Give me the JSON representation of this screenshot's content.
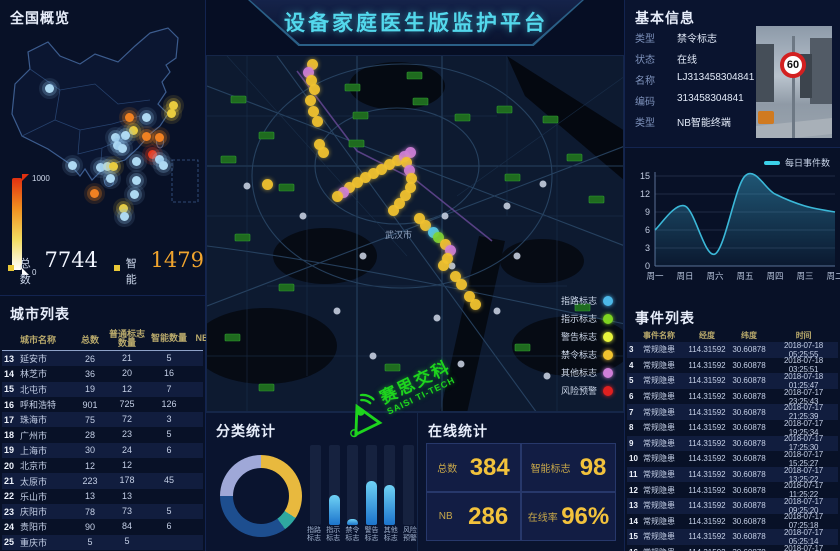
{
  "header": {
    "title": "设备家庭医生版监护平台"
  },
  "overview": {
    "title": "全国概览",
    "scale_max": "1000",
    "scale_min": "0",
    "total_label": "总数",
    "total_value": "7744",
    "smart_label": "智能",
    "smart_value": "1479",
    "dots": [
      {
        "x": 49,
        "y": 88,
        "c": "b"
      },
      {
        "x": 173,
        "y": 105,
        "c": "y"
      },
      {
        "x": 171,
        "y": 113,
        "c": "y"
      },
      {
        "x": 129,
        "y": 117,
        "c": "o"
      },
      {
        "x": 146,
        "y": 117,
        "c": "b"
      },
      {
        "x": 146,
        "y": 136,
        "c": "o"
      },
      {
        "x": 159,
        "y": 137,
        "c": "o"
      },
      {
        "x": 133,
        "y": 130,
        "c": "y"
      },
      {
        "x": 115,
        "y": 137,
        "c": "b"
      },
      {
        "x": 125,
        "y": 135,
        "c": "b"
      },
      {
        "x": 117,
        "y": 145,
        "c": "b"
      },
      {
        "x": 122,
        "y": 148,
        "c": "b"
      },
      {
        "x": 152,
        "y": 154,
        "c": "r"
      },
      {
        "x": 159,
        "y": 159,
        "c": "b"
      },
      {
        "x": 136,
        "y": 161,
        "c": "b"
      },
      {
        "x": 72,
        "y": 165,
        "c": "b"
      },
      {
        "x": 100,
        "y": 167,
        "c": "b"
      },
      {
        "x": 107,
        "y": 166,
        "c": "b"
      },
      {
        "x": 113,
        "y": 166,
        "c": "y"
      },
      {
        "x": 94,
        "y": 193,
        "c": "o"
      },
      {
        "x": 110,
        "y": 178,
        "c": "b"
      },
      {
        "x": 136,
        "y": 180,
        "c": "b"
      },
      {
        "x": 134,
        "y": 194,
        "c": "b"
      },
      {
        "x": 123,
        "y": 208,
        "c": "y"
      },
      {
        "x": 124,
        "y": 216,
        "c": "b"
      },
      {
        "x": 163,
        "y": 165,
        "c": "b"
      }
    ]
  },
  "city_list": {
    "title": "城市列表",
    "columns": [
      "城市名称",
      "总数",
      "普通标志数量",
      "智能数量",
      "NB数量"
    ],
    "rows": [
      {
        "idx": "13",
        "name": "延安市",
        "total": "26",
        "normal": "21",
        "smart": "5",
        "nb": "0"
      },
      {
        "idx": "14",
        "name": "林芝市",
        "total": "36",
        "normal": "20",
        "smart": "16",
        "nb": "0"
      },
      {
        "idx": "15",
        "name": "北屯市",
        "total": "19",
        "normal": "12",
        "smart": "7",
        "nb": "0"
      },
      {
        "idx": "16",
        "name": "呼和浩特",
        "total": "901",
        "normal": "725",
        "smart": "126",
        "nb": "50"
      },
      {
        "idx": "17",
        "name": "珠海市",
        "total": "75",
        "normal": "72",
        "smart": "3",
        "nb": "0"
      },
      {
        "idx": "18",
        "name": "广州市",
        "total": "28",
        "normal": "23",
        "smart": "5",
        "nb": "0"
      },
      {
        "idx": "19",
        "name": "上海市",
        "total": "30",
        "normal": "24",
        "smart": "6",
        "nb": "0"
      },
      {
        "idx": "20",
        "name": "北京市",
        "total": "12",
        "normal": "12",
        "smart": "",
        "nb": "0"
      },
      {
        "idx": "21",
        "name": "太原市",
        "total": "223",
        "normal": "178",
        "smart": "45",
        "nb": "0"
      },
      {
        "idx": "22",
        "name": "乐山市",
        "total": "13",
        "normal": "13",
        "smart": "",
        "nb": "0"
      },
      {
        "idx": "23",
        "name": "庆阳市",
        "total": "78",
        "normal": "73",
        "smart": "5",
        "nb": "0"
      },
      {
        "idx": "24",
        "name": "贵阳市",
        "total": "90",
        "normal": "84",
        "smart": "6",
        "nb": "0"
      },
      {
        "idx": "25",
        "name": "重庆市",
        "total": "5",
        "normal": "5",
        "smart": "",
        "nb": "0"
      }
    ]
  },
  "map": {
    "city_label": "武汉市",
    "legend": [
      {
        "label": "指路标志",
        "color": "#4db8e8"
      },
      {
        "label": "指示标志",
        "color": "#7ed321"
      },
      {
        "label": "警告标志",
        "color": "#e8f53c"
      },
      {
        "label": "禁令标志",
        "color": "#f2c32f"
      },
      {
        "label": "其他标志",
        "color": "#cf7fd8"
      },
      {
        "label": "风险预警",
        "color": "#e02020"
      }
    ],
    "trails": [
      {
        "x": 105,
        "y": 8,
        "c": "y"
      },
      {
        "x": 101,
        "y": 16,
        "c": "p"
      },
      {
        "x": 104,
        "y": 24,
        "c": "y"
      },
      {
        "x": 107,
        "y": 33,
        "c": "y"
      },
      {
        "x": 103,
        "y": 44,
        "c": "y"
      },
      {
        "x": 106,
        "y": 55,
        "c": "y"
      },
      {
        "x": 110,
        "y": 65,
        "c": "y"
      },
      {
        "x": 112,
        "y": 88,
        "c": "y"
      },
      {
        "x": 116,
        "y": 96,
        "c": "y"
      },
      {
        "x": 150,
        "y": 126,
        "c": "y"
      },
      {
        "x": 158,
        "y": 121,
        "c": "y"
      },
      {
        "x": 166,
        "y": 117,
        "c": "y"
      },
      {
        "x": 174,
        "y": 113,
        "c": "y"
      },
      {
        "x": 182,
        "y": 108,
        "c": "y"
      },
      {
        "x": 190,
        "y": 104,
        "c": "y"
      },
      {
        "x": 197,
        "y": 100,
        "c": "p"
      },
      {
        "x": 203,
        "y": 96,
        "c": "p"
      },
      {
        "x": 199,
        "y": 106,
        "c": "y"
      },
      {
        "x": 202,
        "y": 114,
        "c": "p"
      },
      {
        "x": 204,
        "y": 122,
        "c": "y"
      },
      {
        "x": 203,
        "y": 131,
        "c": "y"
      },
      {
        "x": 198,
        "y": 139,
        "c": "y"
      },
      {
        "x": 192,
        "y": 147,
        "c": "y"
      },
      {
        "x": 186,
        "y": 154,
        "c": "y"
      },
      {
        "x": 142,
        "y": 131,
        "c": "y"
      },
      {
        "x": 136,
        "y": 136,
        "c": "p"
      },
      {
        "x": 130,
        "y": 140,
        "c": "y"
      },
      {
        "x": 212,
        "y": 162,
        "c": "y"
      },
      {
        "x": 218,
        "y": 169,
        "c": "y"
      },
      {
        "x": 226,
        "y": 176,
        "c": "b"
      },
      {
        "x": 231,
        "y": 181,
        "c": "g"
      },
      {
        "x": 238,
        "y": 188,
        "c": "y"
      },
      {
        "x": 243,
        "y": 194,
        "c": "p"
      },
      {
        "x": 240,
        "y": 202,
        "c": "y"
      },
      {
        "x": 236,
        "y": 209,
        "c": "y"
      },
      {
        "x": 248,
        "y": 220,
        "c": "y"
      },
      {
        "x": 254,
        "y": 228,
        "c": "y"
      },
      {
        "x": 262,
        "y": 240,
        "c": "y"
      },
      {
        "x": 268,
        "y": 248,
        "c": "y"
      },
      {
        "x": 60,
        "y": 128,
        "c": "y"
      }
    ]
  },
  "basic_info": {
    "title": "基本信息",
    "fields": [
      {
        "label": "类型",
        "value": "禁令标志"
      },
      {
        "label": "状态",
        "value": "在线"
      },
      {
        "label": "名称",
        "value": "LJ313458304841"
      },
      {
        "label": "编码",
        "value": "313458304841"
      },
      {
        "label": "类型",
        "value": "NB智能终端"
      }
    ],
    "photo_sign_text": "60"
  },
  "chart_data": [
    {
      "type": "line",
      "title": "每日事件数",
      "x": [
        "周一",
        "周日",
        "周六",
        "周五",
        "周四",
        "周三",
        "周二"
      ],
      "values": [
        6,
        10,
        2,
        15,
        12,
        10,
        9
      ],
      "ylim": [
        0,
        15
      ],
      "yticks": [
        0,
        3,
        6,
        9,
        12,
        15
      ],
      "legend_position": "top-right",
      "area": true,
      "line_color": "#3bb8d8"
    },
    {
      "type": "pie",
      "title": "分类统计",
      "slices": [
        {
          "value": 34,
          "color": "#e8b93e"
        },
        {
          "value": 6,
          "color": "#2fa8a0"
        },
        {
          "value": 35,
          "color": "#1d4e8f"
        },
        {
          "value": 25,
          "color": "#9fa8d8"
        }
      ],
      "donut": true
    },
    {
      "type": "bar",
      "title": "分类统计",
      "categories": [
        "指路标志",
        "指示标志",
        "禁令标志",
        "警告标志",
        "其他标志",
        "风险预警"
      ],
      "values": [
        0,
        38,
        7,
        55,
        50,
        0
      ],
      "ylim": [
        0,
        100
      ]
    }
  ],
  "category_stats": {
    "title": "分类统计"
  },
  "online_stats": {
    "title": "在线统计",
    "cards": [
      {
        "label": "总数",
        "value": "384"
      },
      {
        "label": "智能标志",
        "value": "98"
      },
      {
        "label": "NB",
        "value": "286"
      },
      {
        "label": "在线率",
        "value": "96%"
      }
    ]
  },
  "event_list": {
    "title": "事件列表",
    "columns": [
      "事件名称",
      "经度",
      "纬度",
      "时间"
    ],
    "rows": [
      {
        "idx": "3",
        "name": "常规隐患",
        "lng": "114.31592",
        "lat": "30.60878",
        "time": "2018-07-18 05:25:55"
      },
      {
        "idx": "4",
        "name": "常规隐患",
        "lng": "114.31592",
        "lat": "30.60878",
        "time": "2018-07-18 03:25:51"
      },
      {
        "idx": "5",
        "name": "常规隐患",
        "lng": "114.31592",
        "lat": "30.60878",
        "time": "2018-07-18 01:25:47"
      },
      {
        "idx": "6",
        "name": "常规隐患",
        "lng": "114.31592",
        "lat": "30.60878",
        "time": "2018-07-17 23:25:43"
      },
      {
        "idx": "7",
        "name": "常规隐患",
        "lng": "114.31592",
        "lat": "30.60878",
        "time": "2018-07-17 21:25:39"
      },
      {
        "idx": "8",
        "name": "常规隐患",
        "lng": "114.31592",
        "lat": "30.60878",
        "time": "2018-07-17 19:25:34"
      },
      {
        "idx": "9",
        "name": "常规隐患",
        "lng": "114.31592",
        "lat": "30.60878",
        "time": "2018-07-17 17:25:30"
      },
      {
        "idx": "10",
        "name": "常规隐患",
        "lng": "114.31592",
        "lat": "30.60878",
        "time": "2018-07-17 15:25:27"
      },
      {
        "idx": "11",
        "name": "常规隐患",
        "lng": "114.31592",
        "lat": "30.60878",
        "time": "2018-07-17 13:25:22"
      },
      {
        "idx": "12",
        "name": "常规隐患",
        "lng": "114.31592",
        "lat": "30.60878",
        "time": "2018-07-17 11:25:22"
      },
      {
        "idx": "13",
        "name": "常规隐患",
        "lng": "114.31592",
        "lat": "30.60878",
        "time": "2018-07-17 09:25:20"
      },
      {
        "idx": "14",
        "name": "常规隐患",
        "lng": "114.31592",
        "lat": "30.60878",
        "time": "2018-07-17 07:25:18"
      },
      {
        "idx": "15",
        "name": "常规隐患",
        "lng": "114.31592",
        "lat": "30.60878",
        "time": "2018-07-17 05:25:14"
      },
      {
        "idx": "16",
        "name": "常规隐患",
        "lng": "114.31592",
        "lat": "30.60878",
        "time": "2018-07-17 03:25:10"
      }
    ]
  },
  "watermark": {
    "cn": "赛思交科",
    "en": "SAISI TI-TECH",
    "color": "#1ed41e"
  }
}
